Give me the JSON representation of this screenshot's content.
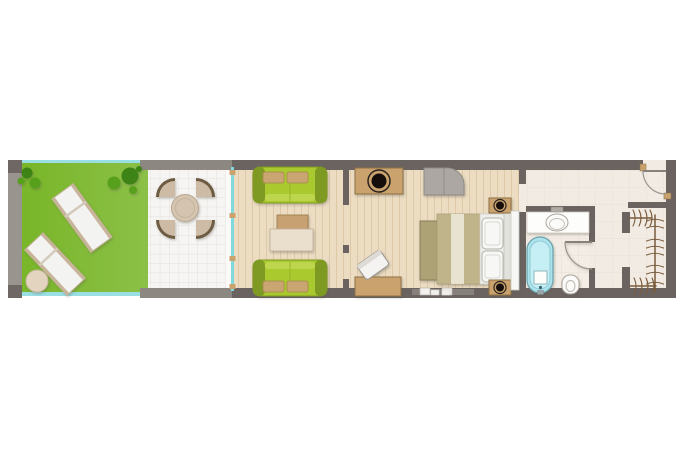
{
  "scene": {
    "type": "floor-plan",
    "rooms": [
      "garden",
      "terrace",
      "living-area",
      "bedroom",
      "bathroom",
      "entrance-hall",
      "walk-in-closet"
    ],
    "furniture": {
      "garden": [
        "sun-lounger",
        "sun-lounger",
        "ottoman",
        "bushes"
      ],
      "terrace": [
        "round-dining-table",
        "fan-chair",
        "fan-chair",
        "fan-chair",
        "fan-chair"
      ],
      "living-area": [
        "sofa",
        "sofa",
        "coffee-table",
        "sliding-glass-door"
      ],
      "bedroom": [
        "console-with-basin",
        "gray-loveseat",
        "desk",
        "desk-chair",
        "double-bed",
        "foot-bench",
        "nightstand",
        "nightstand",
        "wardrobe-panel"
      ],
      "bathroom": [
        "vanity-counter",
        "washbasin",
        "bathtub",
        "toilet",
        "door"
      ],
      "entrance-hall": [
        "entry-door"
      ],
      "walk-in-closet": [
        "clothes-rails",
        "hangers"
      ]
    }
  },
  "colors": {
    "page_bg": "#ffffff",
    "wall_dark": "#6b6360",
    "wall_mid": "#8d8781",
    "wall_light": "#9a948f",
    "wall_cap": "#6e6763",
    "lawn": "#79b629",
    "railing": "#9adfe3",
    "bush_dark": "#3c8316",
    "bush_mid": "#57a01d",
    "lounger": "#f3f3f1",
    "lounger_frame": "#c8b49a",
    "ottoman": "#e3d4c0",
    "terrace_floor": "#f6f5f3",
    "table_top": "#d5c4af",
    "chair_fill": "#cdbba6",
    "chair_rim": "#6e5b43",
    "glass": "#7fd8de",
    "wood": "#ebdcc2",
    "sofa_green": "#a9c92f",
    "sofa_dark": "#7e9a22",
    "sofa_light": "#c3da55",
    "cushion": "#c9a671",
    "coffee_tan": "#c7a171",
    "coffee_cream": "#e9dfcc",
    "tan": "#c9a26e",
    "tan_border": "#8f6f45",
    "black": "#16110d",
    "gray_seat": "#aca7a2",
    "khaki_dark": "#ada276",
    "khaki": "#c0b48a",
    "khaki_light": "#e8e3d0",
    "bed_white": "#ededea",
    "pillow": "#f7f7f5",
    "headboard": "#e2e2dd",
    "bath_floor": "#f3ede5",
    "hall_floor": "#f1ebe3",
    "counter": "#fdfdfc",
    "tub": "#ade3ed",
    "tub_inner": "#c6eef5",
    "fixture_white": "#fbfbfa",
    "door_line": "#9b9591",
    "hanger": "#7a5c3c",
    "panel_white": "#f7f7f5",
    "window_frame": "#87817c",
    "window_glass": "#f4f2ee"
  }
}
